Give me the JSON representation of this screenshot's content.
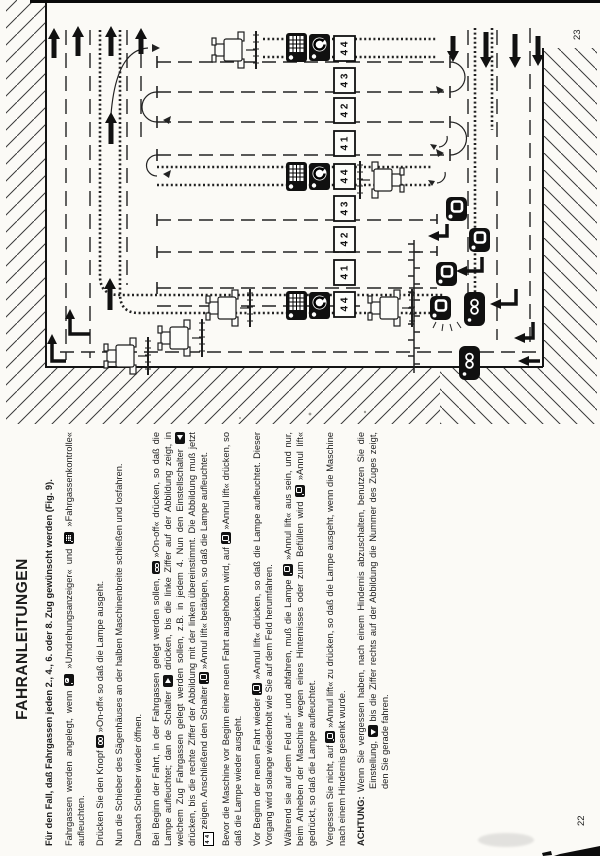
{
  "document": {
    "type": "scanned-manual-page-rotated-90ccw",
    "language": "German",
    "page_numbers": {
      "left_page": "22",
      "right_page": "23"
    }
  },
  "page22": {
    "title": "FAHRANLEITUNGEN",
    "paragraphs": [
      {
        "style": "intro",
        "segments": [
          {
            "t": "Für den Fall, daß Fahrgassen jeden 2., 4., 6. oder 8. Zug gewünscht werden (Fig. 9)."
          }
        ]
      },
      {
        "style": "normal",
        "segments": [
          {
            "t": "Fahrgassen werden angelegt, wenn "
          },
          {
            "icon": "rev-indicator"
          },
          {
            "t": " »Umdrehungsanzeiger« und "
          },
          {
            "icon": "tramline-control"
          },
          {
            "t": " »Fahrgassenkontrolle« aufleuchten."
          }
        ]
      },
      {
        "style": "normal",
        "segments": [
          {
            "t": "Drücken Sie den Knopf "
          },
          {
            "icon": "on-off"
          },
          {
            "t": " »On-off« so daß die Lampe ausgeht."
          }
        ]
      },
      {
        "style": "normal",
        "segments": [
          {
            "t": "Nun die Schieber des Sägenhäuses an der halben Maschinenbreite schließen und losfahren."
          }
        ]
      },
      {
        "style": "normal",
        "segments": [
          {
            "t": "Danach Schieber wieder öffnen."
          }
        ]
      },
      {
        "style": "normal",
        "segments": [
          {
            "t": "Bei Beginn der Fahrt, in der Fahrgassen gelegt werden sollen, "
          },
          {
            "icon": "on-off"
          },
          {
            "t": " »On-off« drücken, so daß die Lampe aufleuchtet; dan de Schalter "
          },
          {
            "icon": "arrow-right-switch"
          },
          {
            "t": " drücken, bis die linke Ziffer auf der Abbildung zeigt, in welchem Zug Fahrgassen gelegt werden sollen, z.B. in jedem 4. Nun den Einstellschalter "
          },
          {
            "icon": "arrow-left-switch"
          },
          {
            "t": " drücken, bis die rechte Ziffer der Abbildung mit der linken übereinstimmt. Die Abbildung muß jetzt "
          },
          {
            "icon": "counter-display"
          },
          {
            "t": " zeigen. Anschließend den Schalter "
          },
          {
            "icon": "annul-lift"
          },
          {
            "t": " »Annul lift« betätigen, so daß die Lampe aufleuchtet."
          }
        ]
      },
      {
        "style": "normal",
        "segments": [
          {
            "t": "Bevor die Maschine vor Beginn einer neuen Fahrt ausgehoben wird, auf "
          },
          {
            "icon": "annul-lift"
          },
          {
            "t": " »Annul lift« drücken, so daß die Lampe wieder ausgeht."
          }
        ]
      },
      {
        "style": "normal",
        "segments": [
          {
            "t": "Vor Beginn der neuen Fahrt wieder "
          },
          {
            "icon": "annul-lift"
          },
          {
            "t": " »Annul lift« drücken, so daß die Lampe aufleuchtet. Dieser Vorgang wird solange wiederholt wie Sie auf dem Feld herumfahren."
          }
        ]
      },
      {
        "style": "normal",
        "segments": [
          {
            "t": "Während sie auf dem Feld auf- und abfahren, muß die Lampe "
          },
          {
            "icon": "annul-lift"
          },
          {
            "t": " »Annul lift« aus sein, und nur, beim Anheben der Maschine wegen eines Hinternisses oder zum Befüllen wird "
          },
          {
            "icon": "annul-lift"
          },
          {
            "t": " »Annul lift« gedrückt, so daß die Lampe aufleuchtet."
          }
        ]
      },
      {
        "style": "normal",
        "segments": [
          {
            "t": "Vergessen Sie nicht, auf "
          },
          {
            "icon": "annul-lift"
          },
          {
            "t": " »Annul lift« zu drücken, so daß die Lampe ausgeht, wenn die Maschine nach einem Hindernis gesenkt wurde."
          }
        ]
      },
      {
        "style": "achtung",
        "label": "ACHTUNG:",
        "segments": [
          {
            "t": "Wenn Sie vergessen haben, nach einem Hindernis abzuschalten, benutzen Sie die Einstellung, "
          },
          {
            "icon": "arrow-down-switch"
          },
          {
            "t": " bis die Ziffer rechts auf der Abbildung die Nummer des Zuges zeigt, den Sie gerade fahren."
          }
        ]
      }
    ],
    "inline_icon_names": [
      "rev-indicator-icon",
      "tramline-control-icon",
      "on-off-icon",
      "arrow-right-switch-icon",
      "arrow-left-switch-icon",
      "counter-display-icon",
      "annul-lift-icon",
      "arrow-down-switch-icon"
    ],
    "counter_display_value": "4 4",
    "page_number": "22"
  },
  "diagram": {
    "description": "Fig. 9 field driving pattern with tramlines (Fahrgassen), serpentine passes, headland turns, button-press positions",
    "counter_boxes": [
      "4 4",
      "4 3",
      "4 2",
      "4 1",
      "4 4",
      "4 3",
      "4 2",
      "4 1",
      "4 4"
    ],
    "icon_names": [
      "tractor-icon",
      "tramline-control-icon",
      "rev-indicator-icon",
      "annul-lift-icon",
      "on-off-icon",
      "up-arrow-icon",
      "down-arrow-icon",
      "turn-elbow-arrow-icon"
    ],
    "page_number": "23"
  }
}
